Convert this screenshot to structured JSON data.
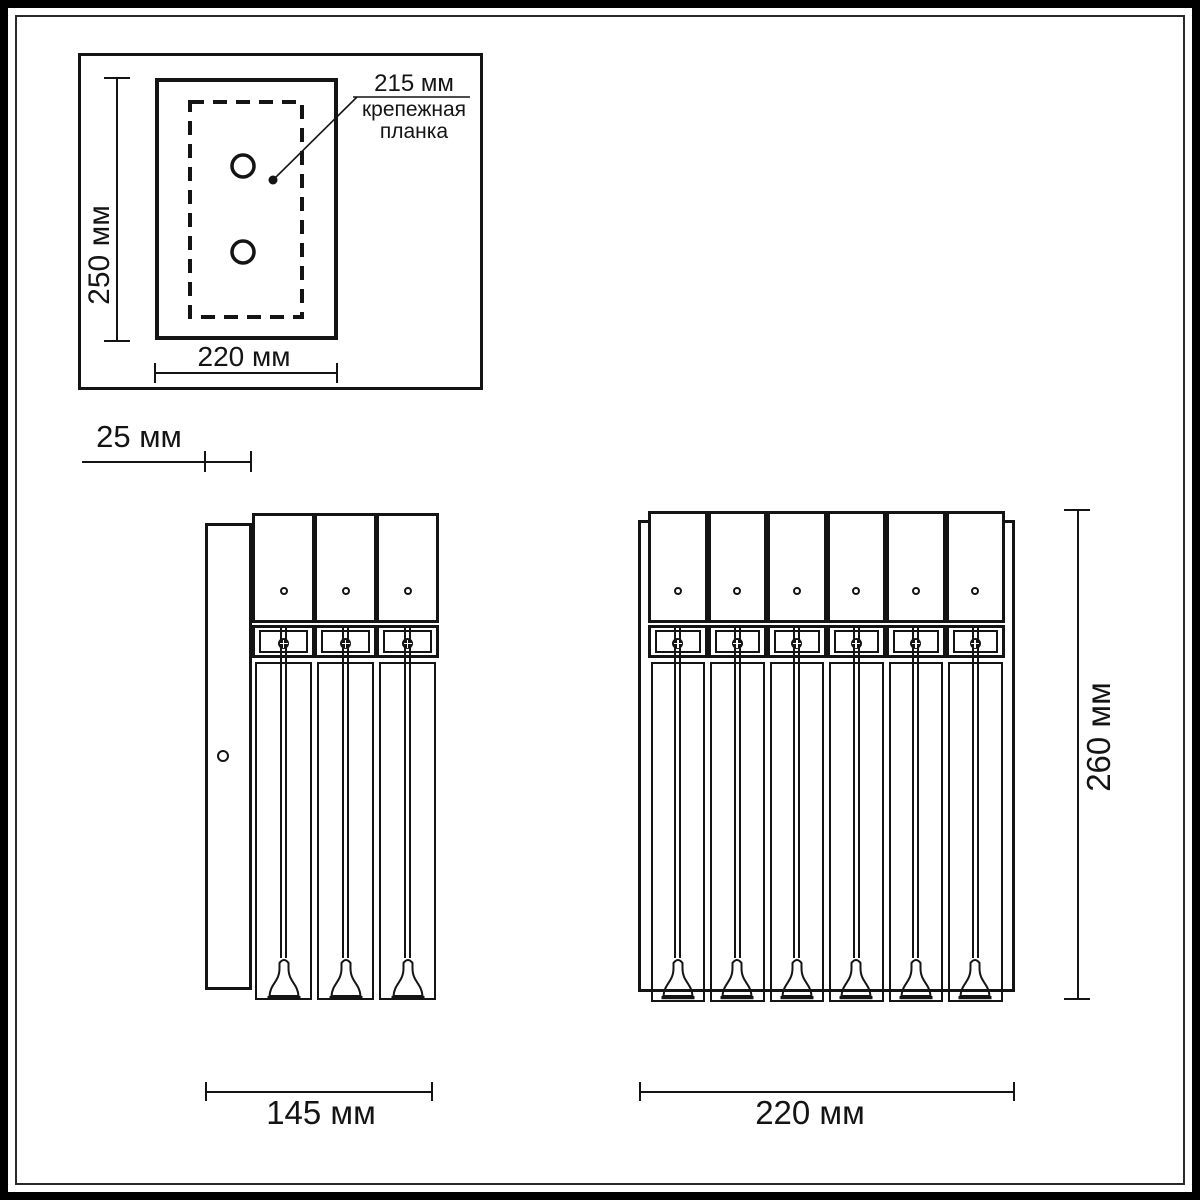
{
  "back_view": {
    "height_label": "250 мм",
    "width_label": "220 мм",
    "callout": {
      "value": "215 мм",
      "name_line1": "крепежная",
      "name_line2": "планка"
    }
  },
  "side_view": {
    "depth_label": "25 мм",
    "width_label": "145 мм",
    "glass_units": 3
  },
  "front_view": {
    "width_label": "220 мм",
    "height_label": "260 мм",
    "glass_units": 6
  },
  "colors": {
    "line": "#141414",
    "background": "#ffffff"
  }
}
